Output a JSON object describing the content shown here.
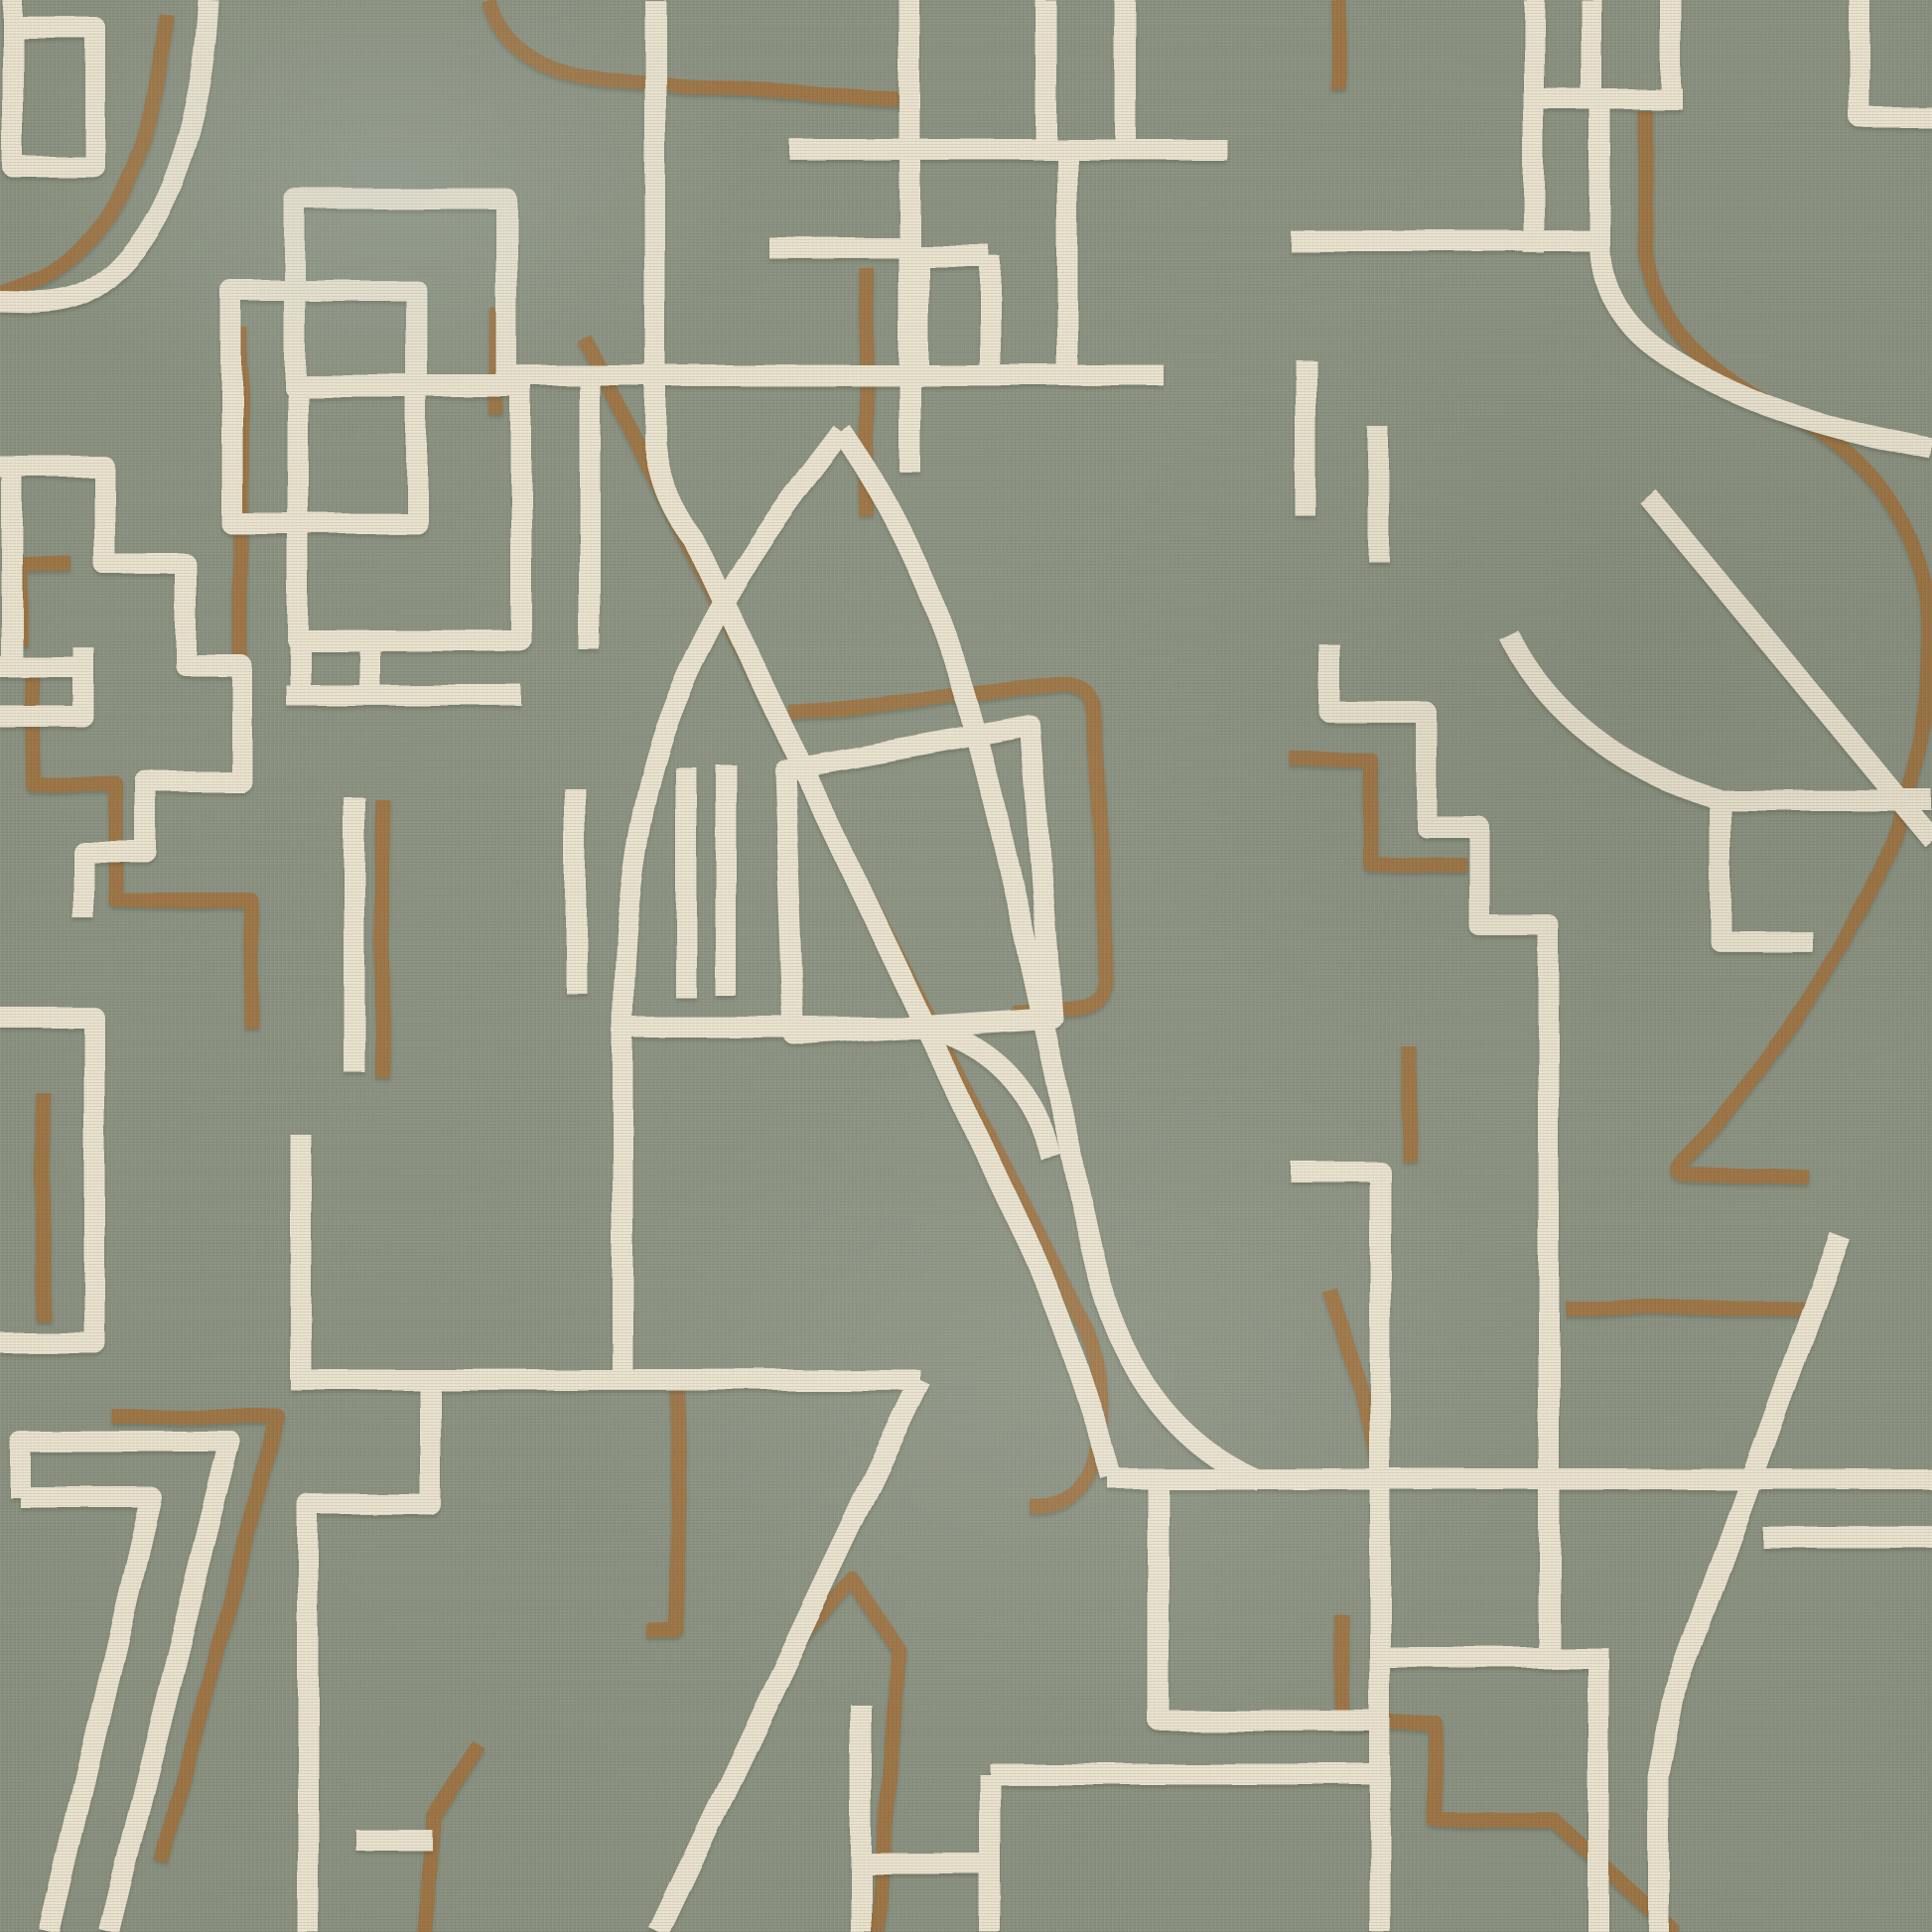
{
  "artwork": {
    "canvas": 1946,
    "background_color": "#8a9180",
    "cream_color": "#ece4d0",
    "brown_color": "#9d7342",
    "cream_stroke_width": 21,
    "brown_stroke_width": 15,
    "shadow_color": "#3a4232",
    "cream_paths": [
      "M 13 0 V 168 H 96 V 28 H 13",
      "M 210 0 C 204 125 168 238 98 288 C 66 310 28 304 0 304",
      "M 233 293 H 420 V 527 H 233 Z",
      "M 297 200 H 510 V 390 H 297 Z",
      "M 300 388 H 525 V 645 H 300 Z",
      "M 302 645 V 700 M 372 645 V 700 M 288 700 H 525",
      "M 0 470 H 105 V 568 H 187 V 670 H 243 V 787 H 147 V 858 H 84 V 925",
      "M 12 480 V 672 M 0 672 H 92",
      "M 0 722 H 84 V 652",
      "M 594 368 V 655",
      "M 580 795 V 1000",
      "M 691 773 V 1005",
      "M 731 770 V 1003",
      "M 357 803 V 1080",
      "M 660 0 V 445 C 664 486 678 516 700 545 L 1030 1240 C 1062 1305 1093 1395 1120 1488",
      "M 916 0 V 475",
      "M 795 150 H 1235",
      "M 775 250 H 916",
      "M 925 258 V 378 M 925 258 H 997 M 997 258 V 378",
      "M 520 378 H 1172",
      "M 1075 150 V 378",
      "M 1053 0 V 150 M 1133 0 V 150",
      "M 848 435 C 806 492 722 590 670 735 C 644 810 629 910 627 1035 V 1390",
      "M 627 1035 H 935",
      "M 848 435 C 892 497 938 585 972 700 C 1015 845 1062 1090 1100 1260 C 1115 1330 1155 1445 1270 1492",
      "M 935 1035 Q 1032 1062 1058 1165",
      "M 1117 1490 H 1946",
      "M 790 775 L 1038 731 L 1060 1025 L 800 1042 Z",
      "M 1300 243 H 1612",
      "M 1545 0 V 255",
      "M 1603 0 V 100 M 1683 0 V 100 M 1545 100 H 1695",
      "M 1612 100 V 255 C 1618 330 1680 366 1760 400 C 1830 430 1900 443 1946 452",
      "M 1873 0 V 118 H 1946",
      "M 1520 640 C 1558 718 1636 778 1733 806 H 1946",
      "M 1733 806 V 948 H 1825",
      "M 1660 500 L 1946 845",
      "M 1340 650 V 718 H 1437 V 833 H 1490 V 932 H 1560 V 1663",
      "M 1380 1670 H 1620 M 1610 1670 V 1946",
      "M 997 1787 H 1390 M 997 1787 V 1946",
      "M 867 1717 V 1946 M 867 1877 H 997",
      "M 1167 1490 V 1733 H 1390",
      "M 303 1143 V 1390",
      "M 293 1390 H 927",
      "M 433 1390 V 1515 H 310 V 1946",
      "M 927 1390 L 663 1946",
      "M 20 1508 V 1452 H 232 L 110 1946",
      "M 20 1508 H 152 L 50 1946",
      "M 0 1025 H 95 V 1352 H 0",
      "M 358 1853 H 435",
      "M 1775 1548 H 1946",
      "M 1853 1245 L 1685 1710 L 1670 1790 V 1946",
      "M 1300 1180 H 1390 V 1946",
      "M 1315 362 V 520 M 1388 430 V 565"
    ],
    "brown_paths": [
      "M 168 15 C 160 130 120 235 45 281 L 0 296",
      "M 500 310 V 418",
      "M 492 0 C 502 42 540 74 610 80 L 780 92 L 905 100",
      "M 1348 0 V 90",
      "M 873 270 V 520",
      "M 242 330 V 680",
      "M 33 677 V 790 H 117 V 907 H 253 V 1035",
      "M 385 805 V 1085",
      "M 43 1100 V 1330",
      "M 588 340 L 1095 1340 C 1110 1382 1112 1432 1104 1468 C 1096 1504 1068 1518 1038 1518",
      "M 795 718 L 1070 690 Q 1099 688 1101 716 L 1116 982 Q 1118 1010 1090 1014 L 1020 1020",
      "M 113 1427 H 280 L 163 1876",
      "M 682 1393 V 1643 H 652",
      "M 795 1660 L 860 1592 L 905 1662 L 884 1946",
      "M 483 1758 L 437 1830 L 427 1946",
      "M 1657 112 V 250 C 1666 332 1726 380 1800 415 C 1876 452 1928 520 1940 600 C 1952 700 1930 810 1878 910 C 1830 1000 1764 1100 1705 1158 C 1678 1185 1690 1182 1712 1183 L 1822 1186",
      "M 1300 765 H 1380 V 870 H 1477",
      "M 1420 1055 V 1170",
      "M 1577 1318 H 1820",
      "M 1340 1300 C 1358 1358 1378 1420 1387 1468",
      "M 1352 1627 V 1735 H 1445 V 1833 H 1565 L 1687 1946",
      "M 72 568 H 20 V 650"
    ]
  }
}
